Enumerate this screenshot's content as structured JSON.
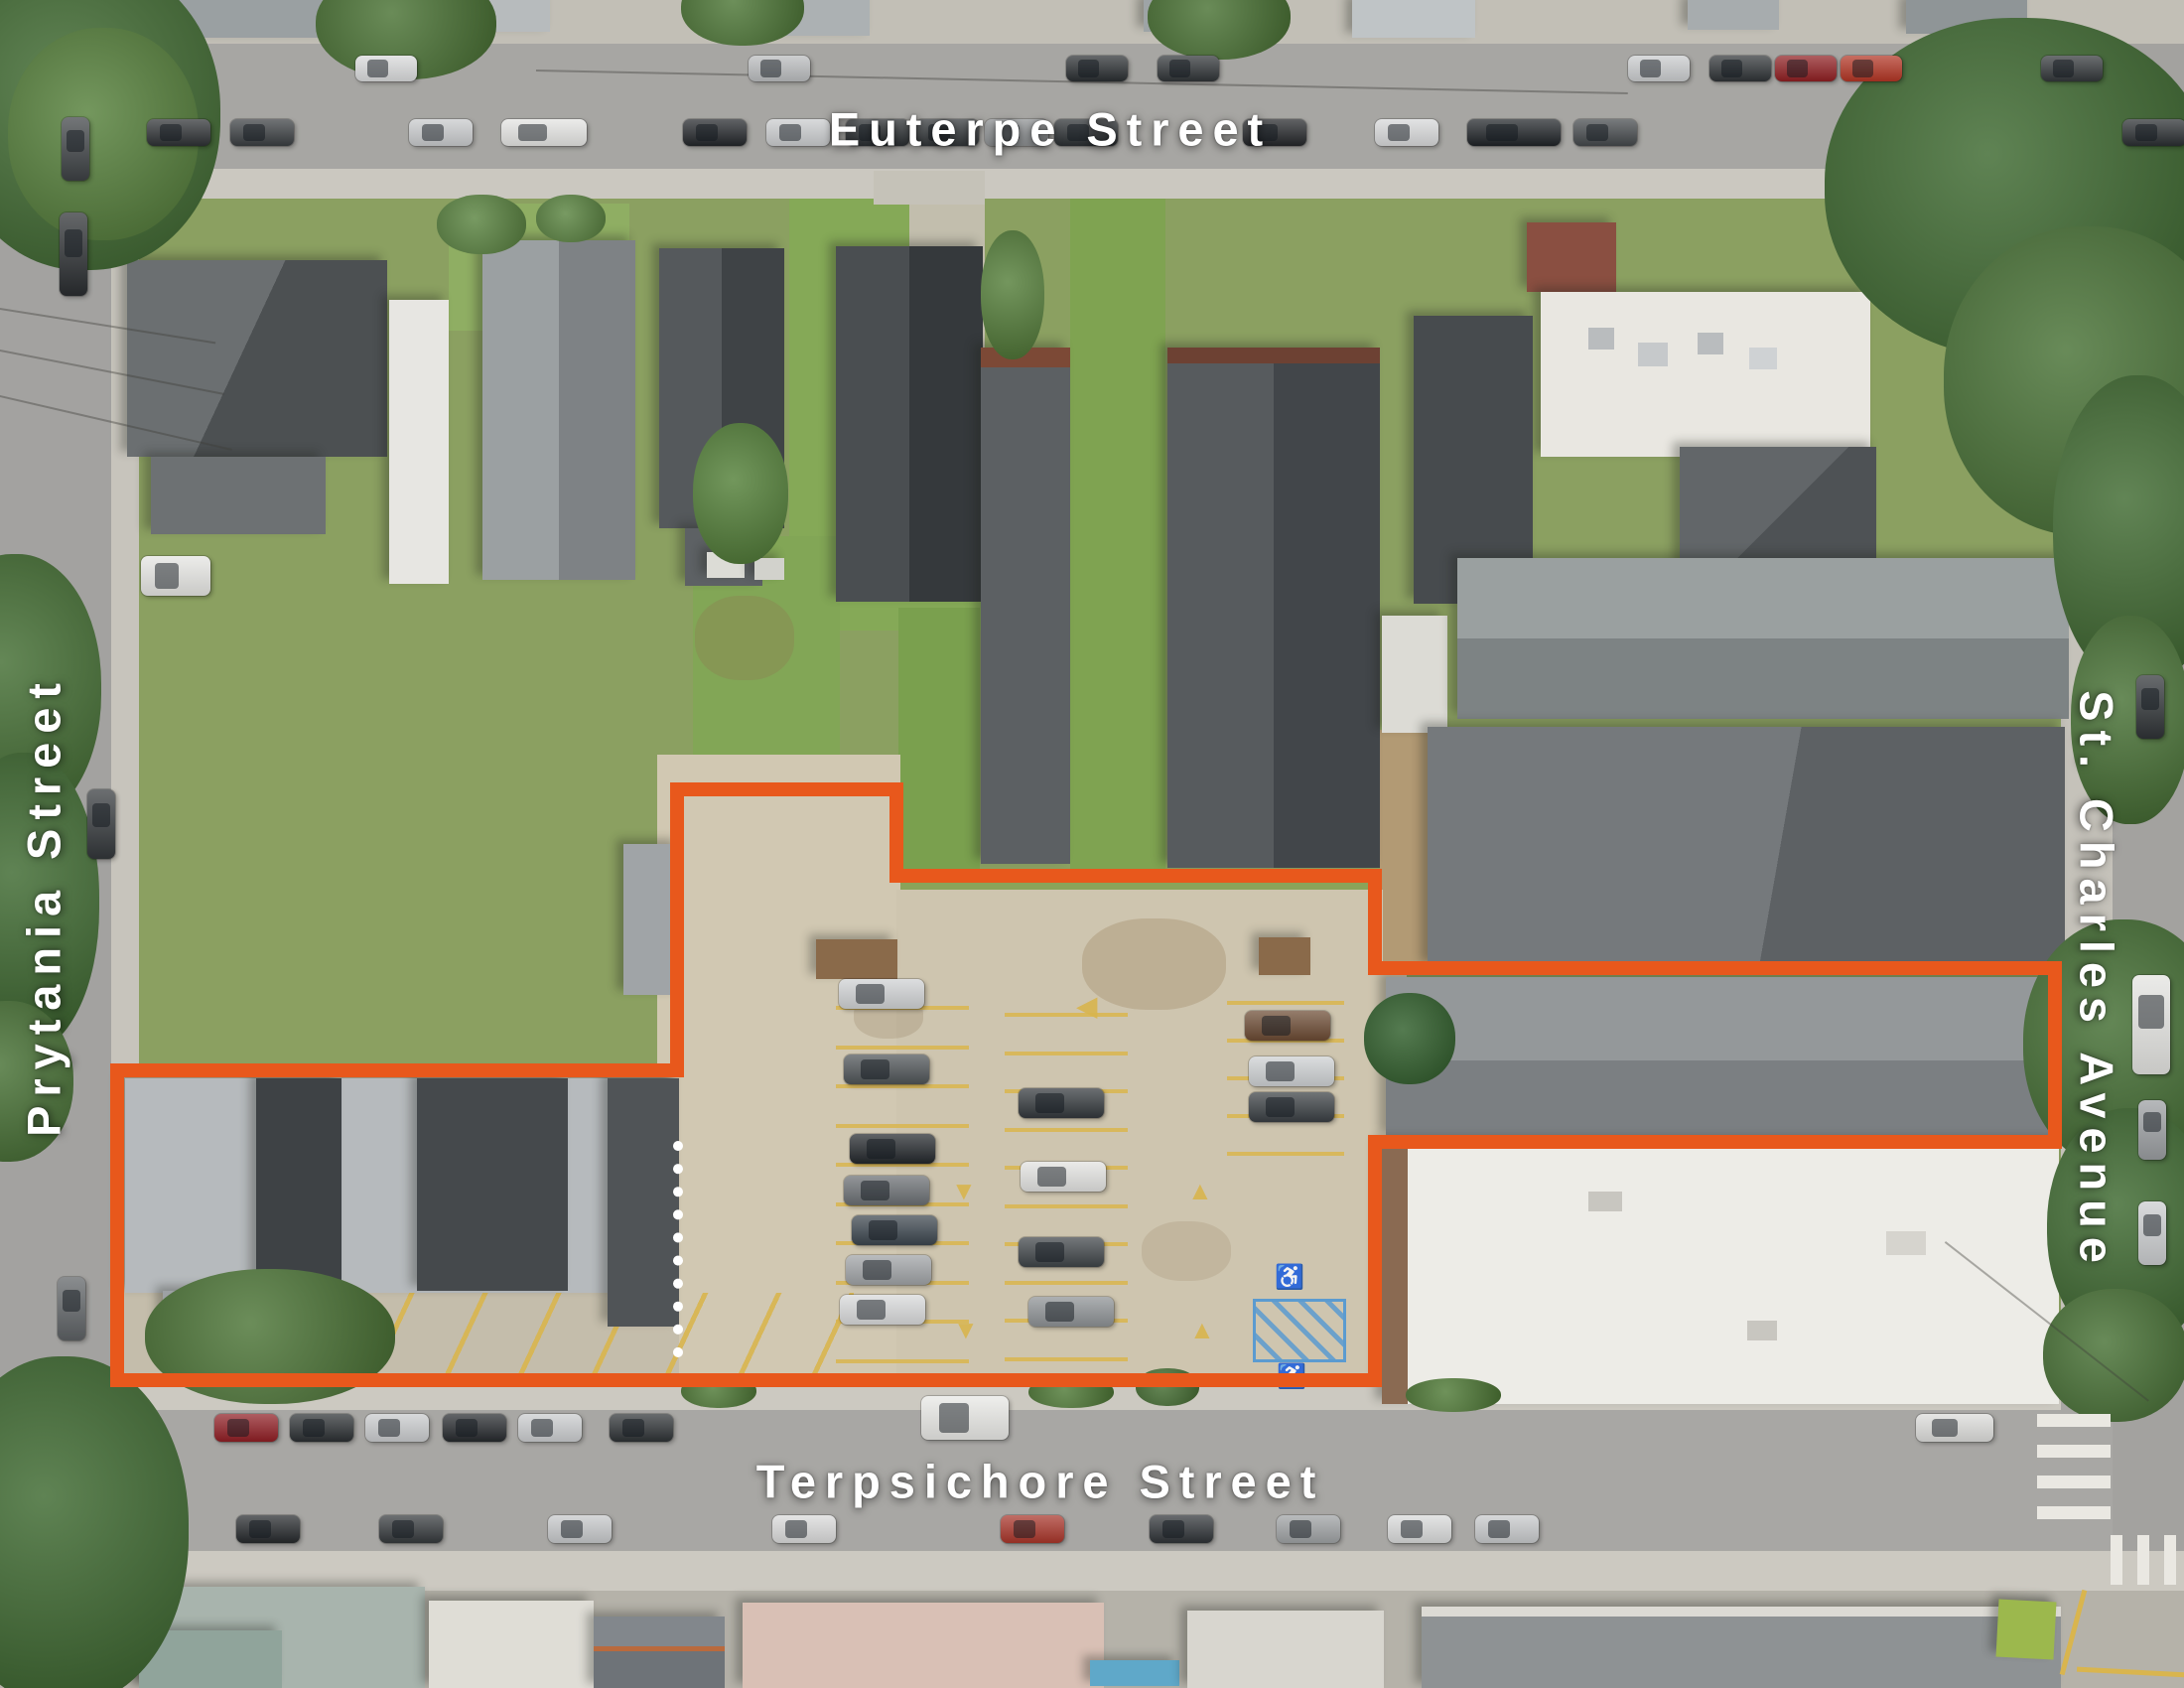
{
  "labels": {
    "street_top": "Euterpe Street",
    "street_left": "Prytania Street",
    "street_right": "St. Charles Avenue",
    "street_bottom": "Terpsichore Street"
  },
  "overlay": {
    "boundary_color": "#e8581c",
    "divider_color": "#ffffff"
  }
}
